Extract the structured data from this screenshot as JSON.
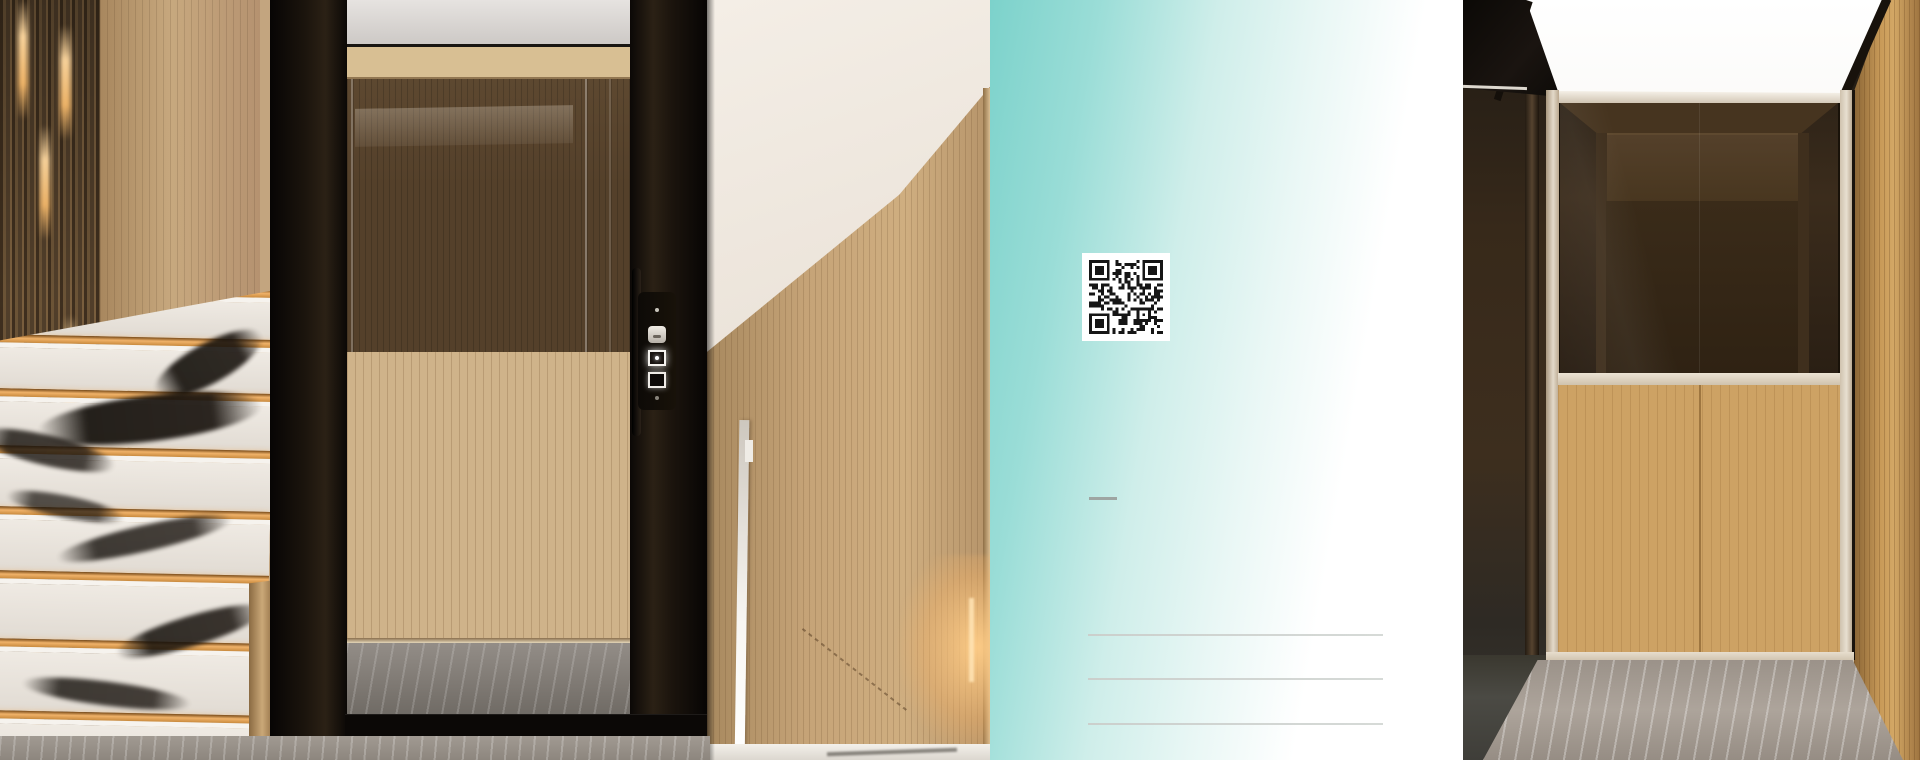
{
  "document": {
    "kind": "home-elevator brochure spread",
    "left_photo": "glass home lift beside marble staircase with LED step lighting",
    "middle_panel": "teal gradient back-cover panel",
    "right_photo": "lift cabin interior with oak panels and smoked glass",
    "qr_label": "qr-code",
    "divider_dash": "",
    "contact_lines": [
      "",
      "",
      ""
    ]
  },
  "colors": {
    "teal_start": "#7cd2cb",
    "teal_mid": "#cfeeea",
    "white": "#ffffff",
    "line_gray": "#cbcfcc",
    "dash_gray": "#9ea5a2",
    "qr_dark": "#161616",
    "led_gold": "#f0b269",
    "frame_black": "#0d0a07",
    "oak": "#cda264",
    "champagne": "#ddd2c0",
    "marble_gray": "#a09890",
    "cab_wood_light": "#cfb38a",
    "cab_wood_dark": "#54402a"
  },
  "stairs": {
    "step_count": 8
  },
  "qr": {
    "modules": 25,
    "seed": 7
  }
}
